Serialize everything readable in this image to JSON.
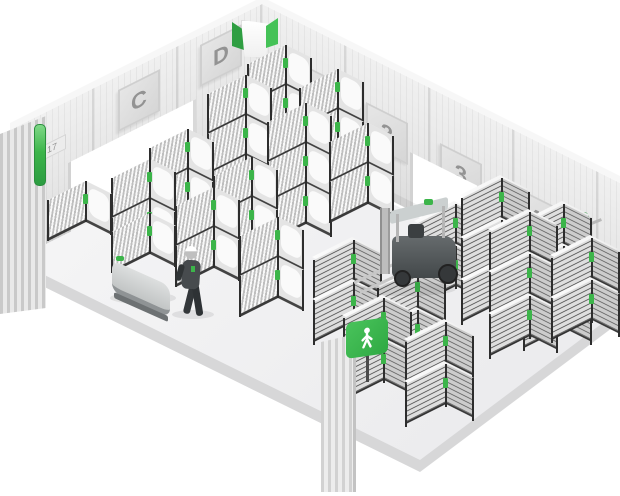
{
  "scene": {
    "background": "#ffffff",
    "accent_green": "#3cb54a",
    "wall_color": "#e9e9e9",
    "floor_color": "#f2f2f3",
    "frame_color": "#2d2d2d"
  },
  "walls": {
    "left_zones": [
      {
        "label": "C"
      },
      {
        "label": "D"
      }
    ],
    "right_zones": [
      {
        "label": "1"
      },
      {
        "label": "2"
      },
      {
        "label": "3"
      },
      {
        "label": "4"
      }
    ],
    "left_door_sign": "17"
  },
  "signage": {
    "overhead_sign_color": "#3cb54a",
    "pedestrian_sign_color": "#3cb54a",
    "andon_light_color": "#3cb54a"
  },
  "racks": [
    {
      "type": "roll",
      "x": 248,
      "y": 64,
      "tiers": 4
    },
    {
      "type": "roll",
      "x": 208,
      "y": 94,
      "tiers": 4
    },
    {
      "type": "roll",
      "x": 300,
      "y": 88,
      "tiers": 3
    },
    {
      "type": "roll",
      "x": 268,
      "y": 122,
      "tiers": 3
    },
    {
      "type": "roll",
      "x": 330,
      "y": 142,
      "tiers": 2
    },
    {
      "type": "roll",
      "x": 150,
      "y": 148,
      "tiers": 2
    },
    {
      "type": "roll",
      "x": 214,
      "y": 176,
      "tiers": 2
    },
    {
      "type": "roll",
      "x": 112,
      "y": 178,
      "tiers": 2
    },
    {
      "type": "roll",
      "x": 176,
      "y": 206,
      "tiers": 2
    },
    {
      "type": "roll",
      "x": 240,
      "y": 236,
      "tiers": 2
    },
    {
      "type": "roll",
      "x": 48,
      "y": 200,
      "tiers": 1
    },
    {
      "type": "roll",
      "x": 112,
      "y": 232,
      "tiers": 1
    },
    {
      "type": "bin",
      "x": 416,
      "y": 224,
      "tiers": 2
    },
    {
      "type": "bin",
      "x": 462,
      "y": 198,
      "tiers": 3
    },
    {
      "type": "bin",
      "x": 524,
      "y": 224,
      "tiers": 3
    },
    {
      "type": "bin",
      "x": 490,
      "y": 232,
      "tiers": 3
    },
    {
      "type": "bin",
      "x": 552,
      "y": 258,
      "tiers": 2
    },
    {
      "type": "bin",
      "x": 314,
      "y": 260,
      "tiers": 2
    },
    {
      "type": "bin",
      "x": 378,
      "y": 288,
      "tiers": 2
    },
    {
      "type": "bin",
      "x": 344,
      "y": 318,
      "tiers": 2
    },
    {
      "type": "bin",
      "x": 406,
      "y": 342,
      "tiers": 2
    }
  ]
}
